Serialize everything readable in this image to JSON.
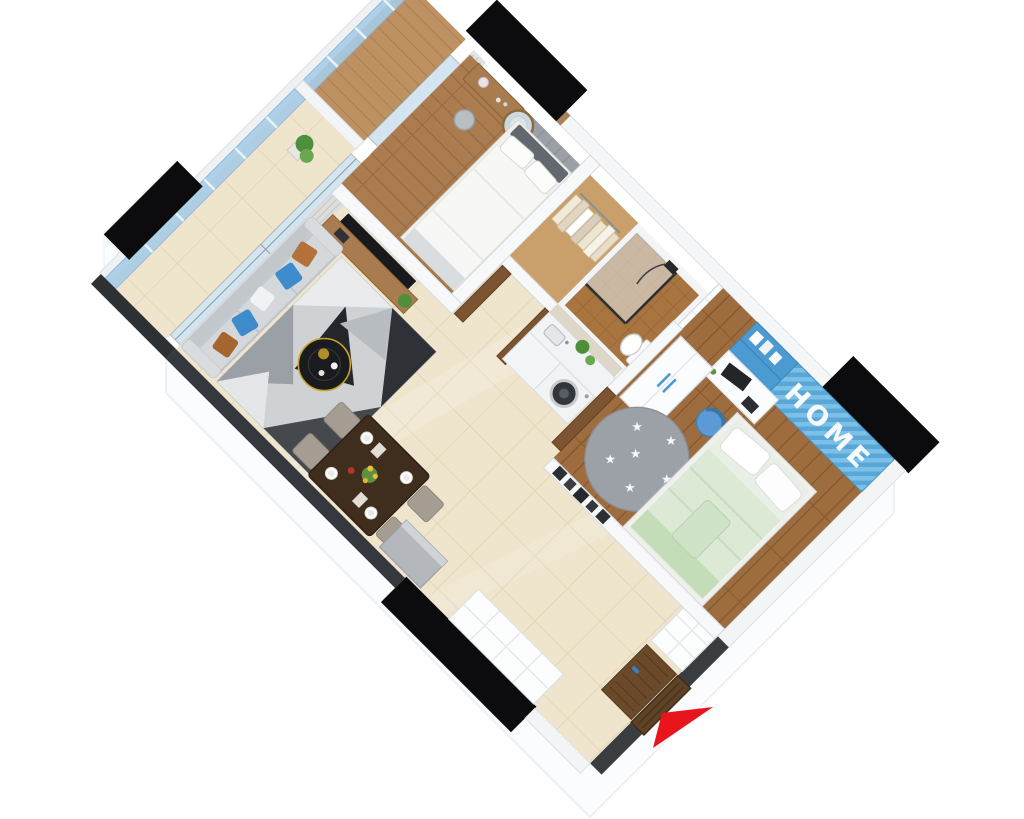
{
  "scene": {
    "type": "3d-isometric-floorplan-render",
    "description": "Photorealistic axonometric cutaway render of a two-bedroom apartment, rotated 45 degrees on a white background, with black section-cut exterior walls, glass balconies, cream tiled living areas, wood-floored bedrooms and a red entrance direction arrow.",
    "background_color": "#ffffff",
    "view": "isometric top-down cutaway"
  },
  "labels": {
    "home_wall_text": "HOME"
  },
  "rooms": [
    {
      "name": "master-bedroom",
      "furniture": [
        "double-bed",
        "vanity-desk",
        "round-mirror",
        "stool",
        "padded-headboard-wall",
        "balcony-door"
      ]
    },
    {
      "name": "walk-in-closet",
      "furniture": [
        "clothes-rail",
        "hanging-clothes"
      ]
    },
    {
      "name": "bathroom",
      "furniture": [
        "shower-enclosure",
        "shower-head",
        "toilet",
        "duct-niche"
      ]
    },
    {
      "name": "kitchen",
      "furniture": [
        "counter",
        "sink",
        "washing-machine",
        "plants"
      ]
    },
    {
      "name": "living-room",
      "furniture": [
        "sofa",
        "throw-pillows",
        "geometric-rug",
        "round-coffee-table",
        "tv",
        "tv-console",
        "plant"
      ]
    },
    {
      "name": "dining-area",
      "furniture": [
        "dining-table",
        "four-chairs",
        "place-settings",
        "flower-vase",
        "gray-cabinet"
      ]
    },
    {
      "name": "kids-bedroom",
      "furniture": [
        "single-bed",
        "white-wardrobe",
        "blue-wall-shelves",
        "desk",
        "monitor",
        "blue-desk-chair",
        "star-rug",
        "picture-frames",
        "home-accent-wall"
      ]
    },
    {
      "name": "entrance-hall",
      "furniture": [
        "entry-door",
        "doormat",
        "shoe-shelves"
      ]
    },
    {
      "name": "master-balcony",
      "furniture": [
        "glass-railing",
        "curtains"
      ]
    },
    {
      "name": "living-balcony",
      "furniture": [
        "glass-railing",
        "curtains",
        "plant-pot"
      ]
    }
  ],
  "colors": {
    "accent_blue": "#55a4d8",
    "glass_blue": "#a6cce6",
    "tile_cream": "#efe5cd",
    "wood_brown": "#a97a4e",
    "wall_cut_black": "#0c0c0e",
    "wall_gray": "#3a3d40",
    "arrow_red": "#e8151c",
    "kids_bed_green": "#dce9d5",
    "sofa_gray": "#ccd1d5"
  }
}
